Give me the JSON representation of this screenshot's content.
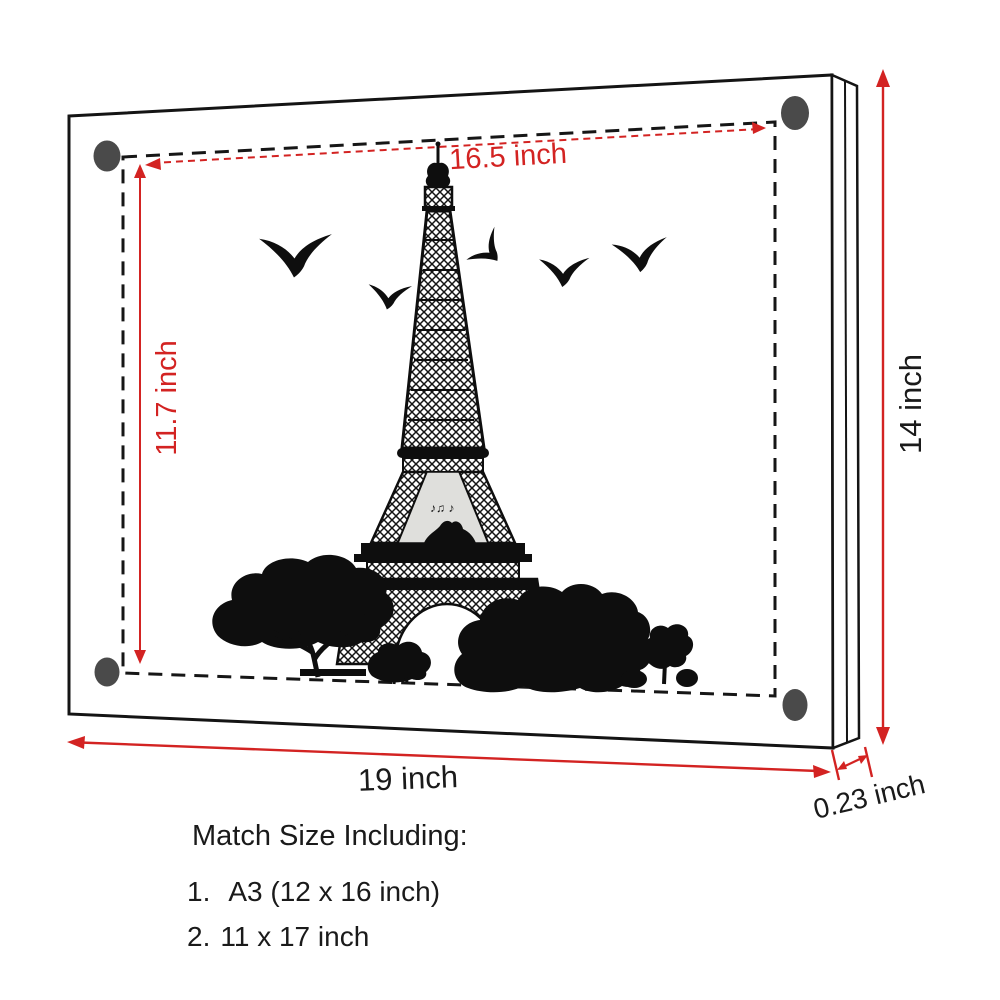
{
  "colors": {
    "dimension_red": "#d32322",
    "ink_black": "#1a1a1a",
    "magnet_gray": "#4a4a4a",
    "panel_gray": "#dfdfdc",
    "art_black": "#0e0e0e",
    "background": "#ffffff"
  },
  "dimensions": {
    "inner_width": "16.5 inch",
    "inner_height": "11.7 inch",
    "outer_height": "14 inch",
    "outer_width": "19 inch",
    "thickness": "0.23 inch"
  },
  "artwork": {
    "subject": "eiffel-tower-with-birds-and-trees",
    "music_notes": "♪♫ ♪"
  },
  "footer": {
    "heading": "Match Size Including:",
    "items": [
      {
        "number": "1.",
        "label": "A3 (12 x 16 inch)"
      },
      {
        "number": "2.",
        "label": "11 x 17 inch"
      }
    ]
  }
}
